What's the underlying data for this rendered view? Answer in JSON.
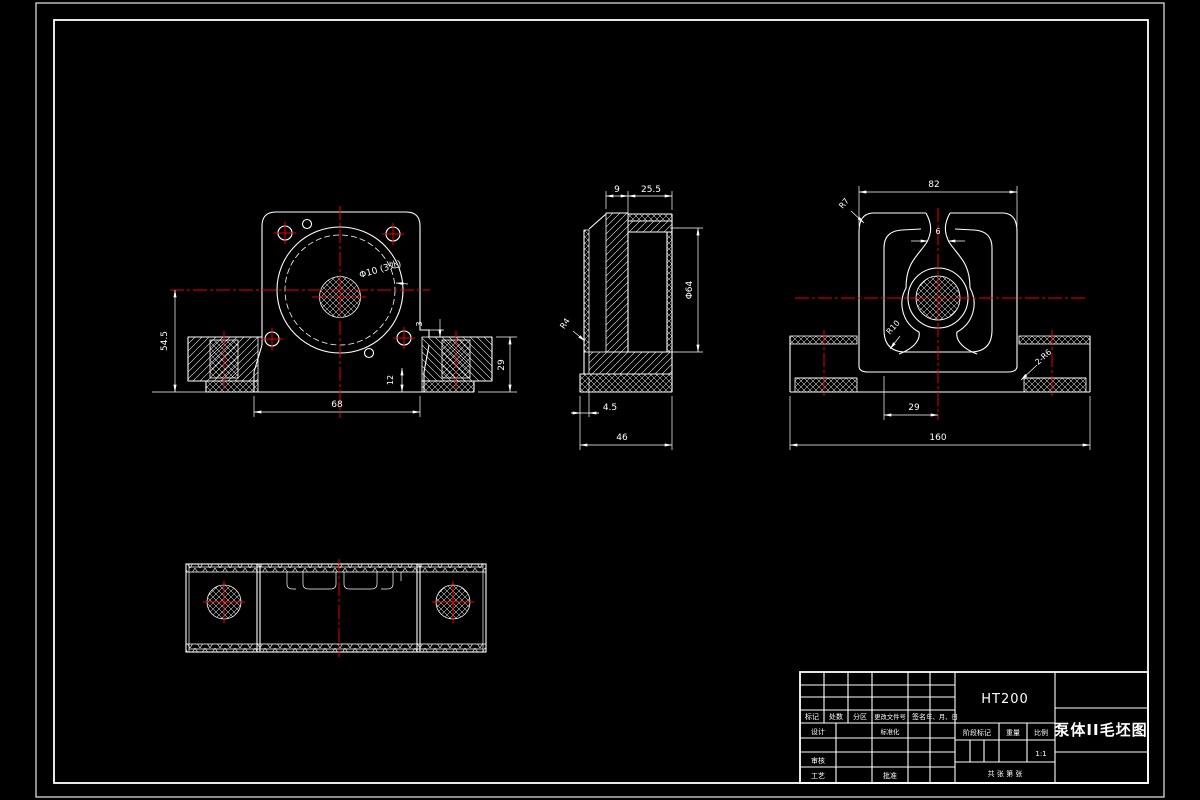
{
  "drawing": {
    "material": "HT200",
    "title": "泵体II毛坯图"
  },
  "title_block": {
    "header_cols": {
      "mark": "标记",
      "count": "处数",
      "zone": "分区",
      "change_file_no": "更改文件号",
      "signature": "签名",
      "date": "年、月、日"
    },
    "design": "设计",
    "standardization": "标准化",
    "check": "审核",
    "process": "工艺",
    "approve": "批准",
    "stage_mark": "阶段标记",
    "weight": "重量",
    "scale": "比例",
    "scale_value": "1:1",
    "sheet_info": "共  张  第  张"
  },
  "views": {
    "front": {
      "dims": {
        "center_to_base": "54.5",
        "base_width": "68",
        "foot_height": "29",
        "slab_height": "12",
        "step": "3",
        "holes": "Φ10 (3处)"
      }
    },
    "side": {
      "dims": {
        "flange_thk": "9",
        "bore_depth": "25.5",
        "bore_dia": "Φ64",
        "fillet": "R4",
        "step": "4.5",
        "width": "46"
      }
    },
    "section": {
      "dims": {
        "body_width": "82",
        "top_fillet": "R7",
        "slot_width": "6",
        "web_fillet": "R10",
        "leg_offset": "29",
        "base_width": "160",
        "pad_fillet": "2-R6"
      }
    }
  }
}
